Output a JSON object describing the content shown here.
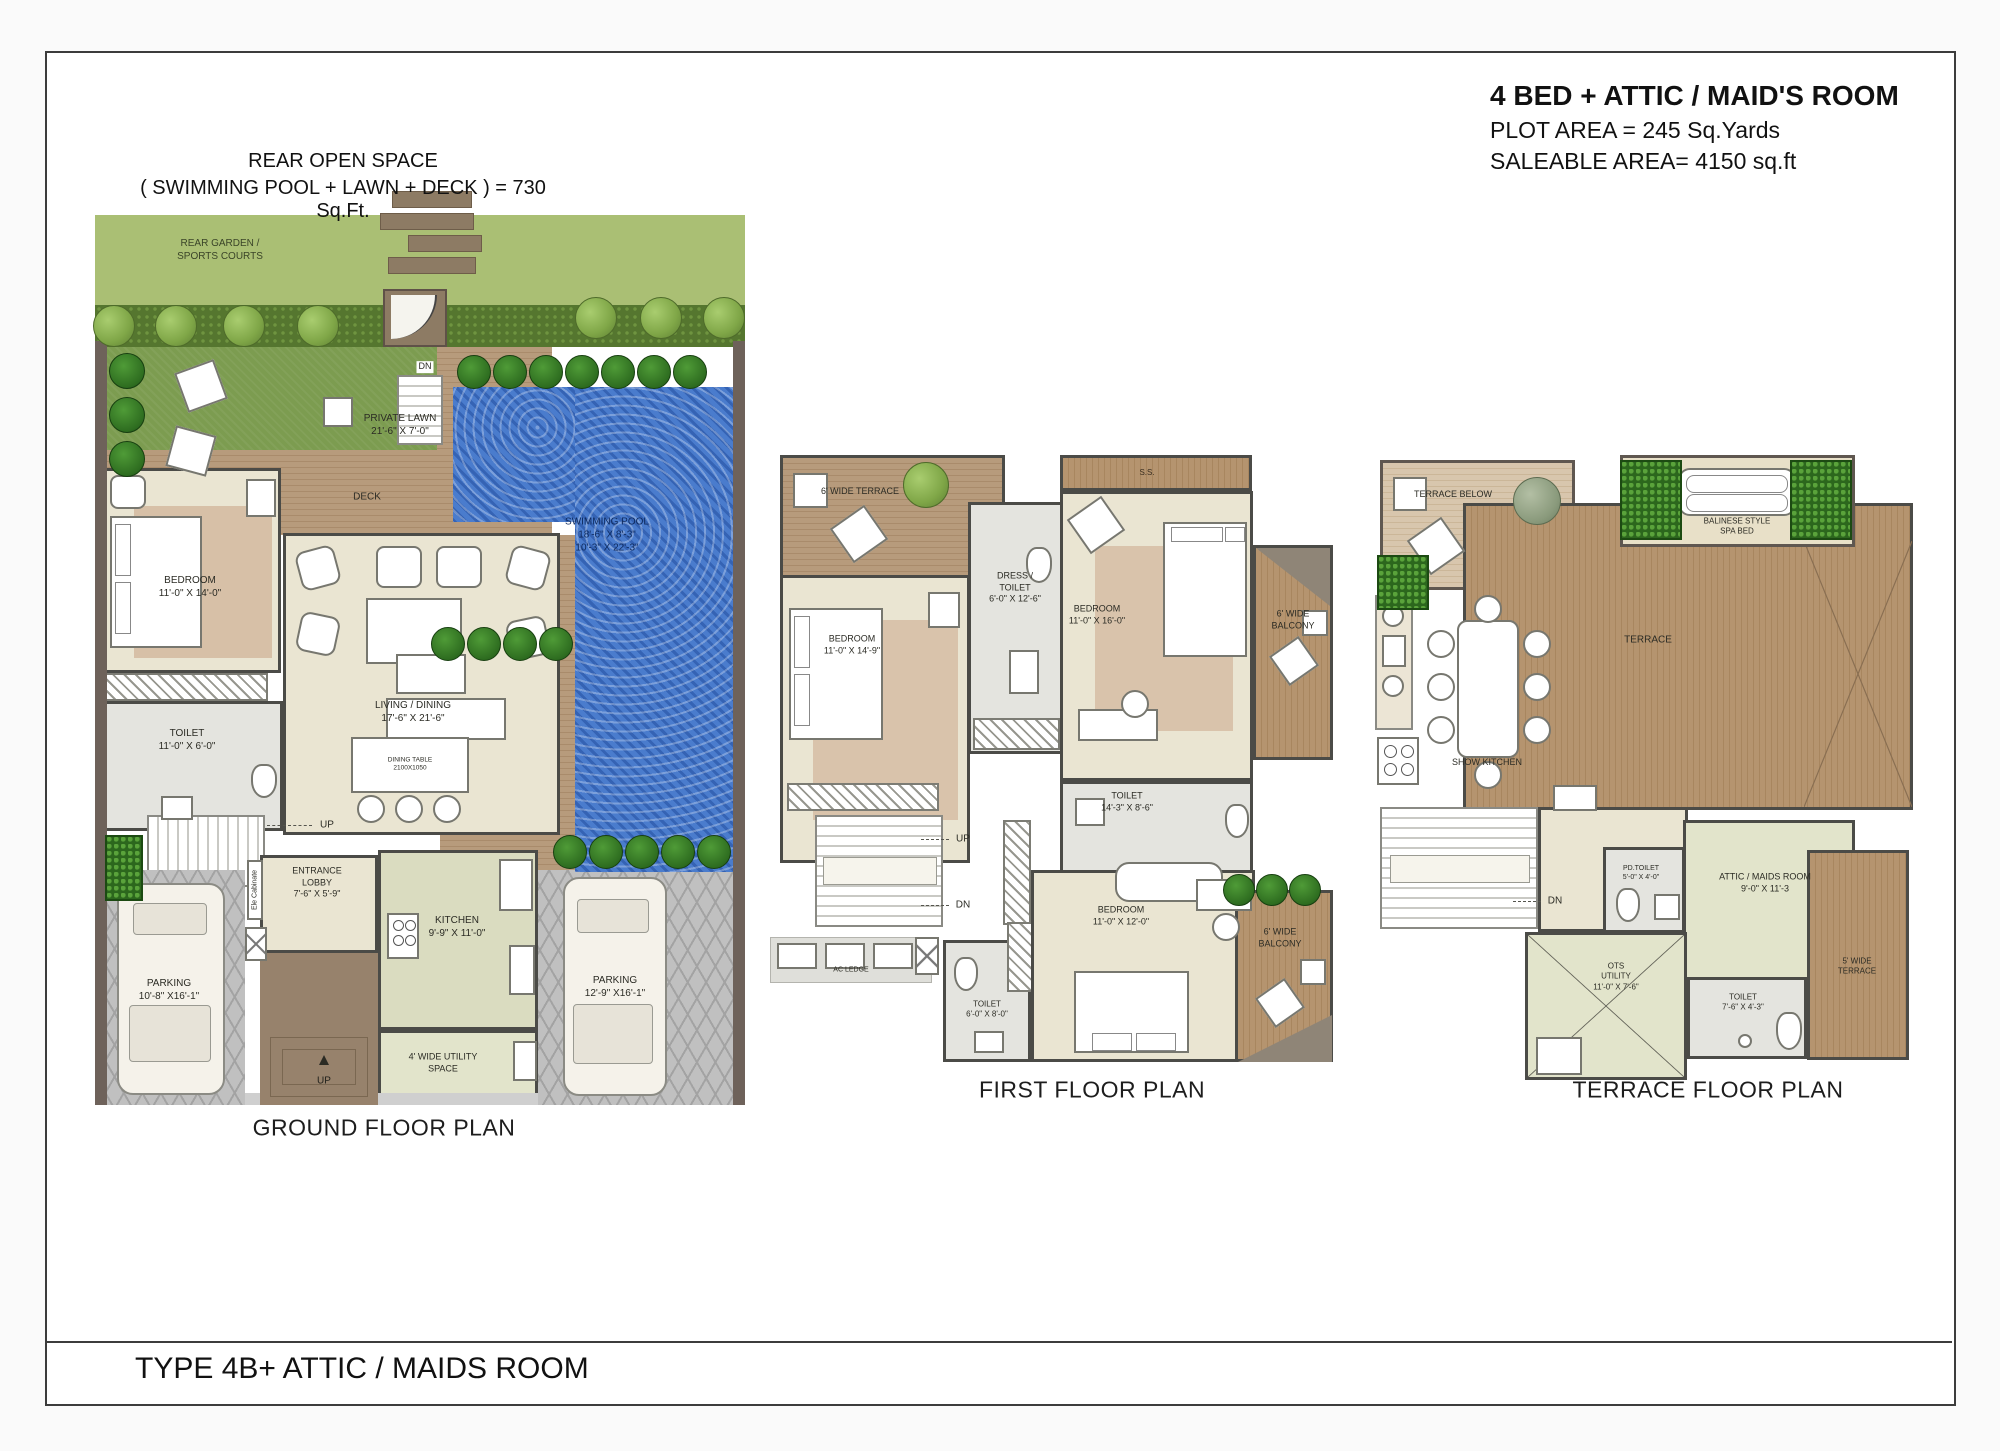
{
  "page": {
    "header": {
      "title": "4 BED + ATTIC / MAID'S ROOM",
      "plot_area": "PLOT AREA  =  245 Sq.Yards",
      "saleable_area": "SALEABLE  AREA=  4150 sq.ft"
    },
    "rear_note": {
      "line1": "REAR OPEN SPACE",
      "line2": "( SWIMMING POOL + LAWN + DECK ) = 730 Sq.Ft."
    },
    "footer": {
      "type_label": "TYPE 4B+ ATTIC / MAIDS ROOM"
    }
  },
  "ground": {
    "caption": "GROUND FLOOR PLAN",
    "rear_garden": {
      "l1": "REAR GARDEN /",
      "l2": "SPORTS COURTS"
    },
    "dn": "DN",
    "private_lawn": {
      "l1": "PRIVATE LAWN",
      "l2": "21'-6\" X 7'-0\""
    },
    "deck": "DECK",
    "pool": {
      "l1": "SWIMMING POOL",
      "l2": "18'-6\" X 8'-3\"",
      "l3": "10'-3\" X 22'-3\""
    },
    "bedroom": {
      "l1": "BEDROOM",
      "l2": "11'-0\" X 14'-0\""
    },
    "toilet": {
      "l1": "TOILET",
      "l2": "11'-0\" X 6'-0\""
    },
    "living": {
      "l1": "LIVING / DINING",
      "l2": "17'-6\" X 21'-6\""
    },
    "dining_table": {
      "l1": "DINING TABLE",
      "l2": "2100X1050"
    },
    "up1": "UP",
    "ele_cab": "Ele Cabinate",
    "entrance": {
      "l1": "ENTRANCE",
      "l2": "LOBBY",
      "l3": "7'-6\" X 5'-9\""
    },
    "kitchen": {
      "l1": "KITCHEN",
      "l2": "9'-9\" X 11'-0\""
    },
    "parking_l": {
      "l1": "PARKING",
      "l2": "10'-8\" X16'-1\""
    },
    "parking_r": {
      "l1": "PARKING",
      "l2": "12'-9\" X16'-1\""
    },
    "utility": {
      "l1": "4' WIDE UTILITY",
      "l2": "SPACE"
    },
    "up2": "UP"
  },
  "first": {
    "caption": "FIRST FLOOR PLAN",
    "terrace": "6' WIDE TERRACE",
    "ss": "S.S.",
    "dress": {
      "l1": "DRESS /",
      "l2": "TOILET",
      "l3": "6'-0\" X 12'-6\""
    },
    "bedroom_r": {
      "l1": "BEDROOM",
      "l2": "11'-0\" X 16'-0\""
    },
    "balcony_r": {
      "l1": "6' WIDE",
      "l2": "BALCONY"
    },
    "bedroom_l": {
      "l1": "BEDROOM",
      "l2": "11'-0\" X 14'-9\""
    },
    "toilet_m": {
      "l1": "TOILET",
      "l2": "14'-3\" X 8'-6\""
    },
    "up": "UP",
    "dn": "DN",
    "ac_ledge": "AC LEDGE",
    "toilet_s": {
      "l1": "TOILET",
      "l2": "6'-0\" X 8'-0\""
    },
    "bedroom_b": {
      "l1": "BEDROOM",
      "l2": "11'-0\" X 12'-0\""
    },
    "balcony_b": {
      "l1": "6' WIDE",
      "l2": "BALCONY"
    }
  },
  "terrace": {
    "caption": "TERRACE FLOOR PLAN",
    "terrace_below": "TERRACE BELOW",
    "spa": {
      "l1": "BALINESE STYLE",
      "l2": "SPA BED"
    },
    "main": "TERRACE",
    "show_kitchen": "SHOW KITCHEN",
    "dn": "DN",
    "pd_toilet": {
      "l1": "PD.TOILET",
      "l2": "5'-0\" X 4'-0\""
    },
    "attic": {
      "l1": "ATTIC / MAIDS ROOM",
      "l2": "9'-0\" X 11'-3"
    },
    "ots": {
      "l1": "OTS",
      "l2": "UTILITY",
      "l3": "11'-0\" X 7'-6\""
    },
    "toilet": {
      "l1": "TOILET",
      "l2": "7'-6\" X 4'-3\""
    },
    "terrace5": {
      "l1": "5' WIDE",
      "l2": "TERRACE"
    }
  },
  "colors": {
    "wall": "#4b4b47",
    "boundary_wall": "#6e625a",
    "pool_water": "#4a7ccd",
    "lawn": "#7c9c50",
    "garden": "#aabf74",
    "deck_wood": "#b5946f",
    "room_beige": "#eae5d2",
    "room_gray": "#e4e4df",
    "room_green": "#dadcc0"
  }
}
